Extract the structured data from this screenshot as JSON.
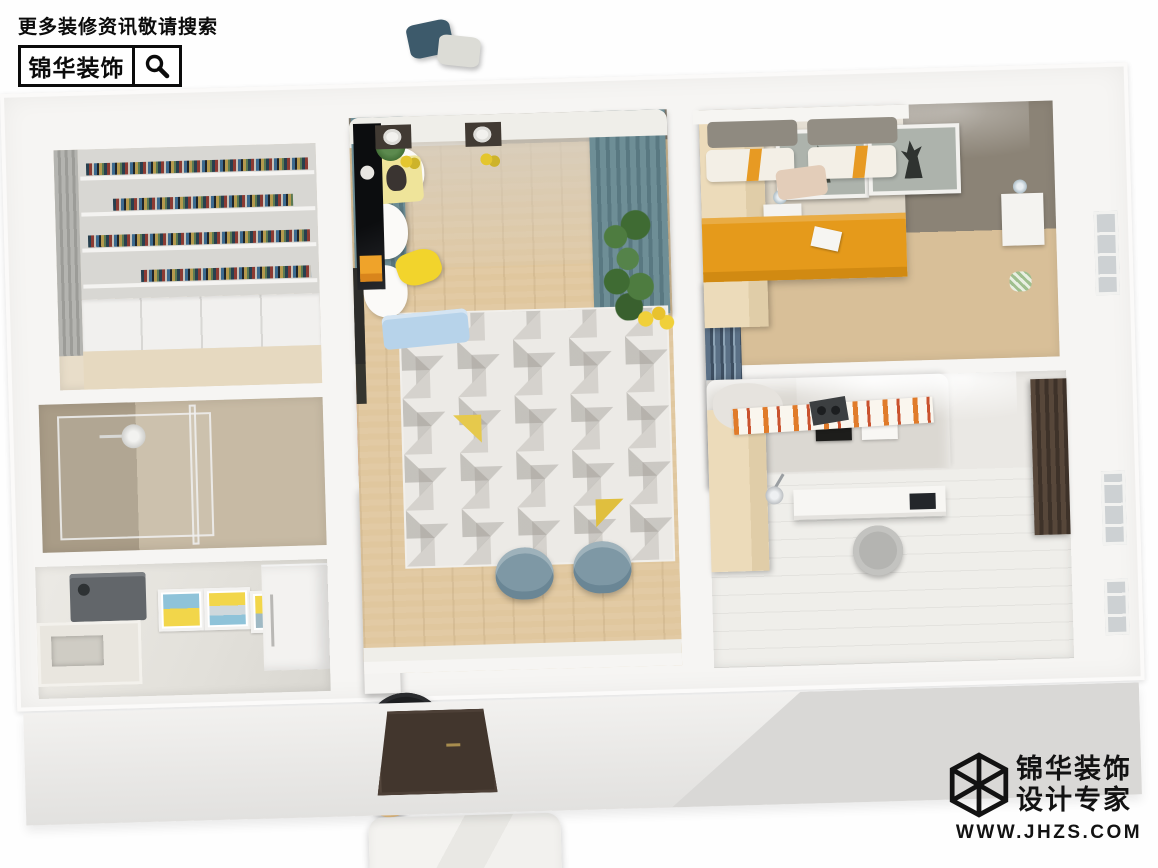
{
  "watermark_top": {
    "search_hint": "更多装修资讯敬请搜索",
    "brand": "锦华装饰",
    "icon": "magnifier-search"
  },
  "watermark_bottom": {
    "brand_line1": "锦华装饰",
    "brand_line2": "设计专家",
    "website": "WWW.JHZS.COM",
    "icon": "isometric-cube-logo"
  },
  "decor": {
    "poster_love": "LOVE PEACE",
    "poster_youme": "you & me"
  },
  "palette": {
    "wall_white": "#f6f5f3",
    "wall_taupe": "#8b8376",
    "wood_floor": "#e0c79e",
    "curtain_teal": "#6e8e96",
    "curtain_navy": "#5b7086",
    "curtain_brown": "#57473a",
    "armchair_coral": "#dd6e62",
    "accent_yellow": "#f2d42c",
    "bed_orange": "#e59a1b",
    "runner_orange": "#e07b2a",
    "throw_blue": "#b7d3ea",
    "dining_chair_blue": "#7e98a5",
    "logo_black": "#121212"
  }
}
